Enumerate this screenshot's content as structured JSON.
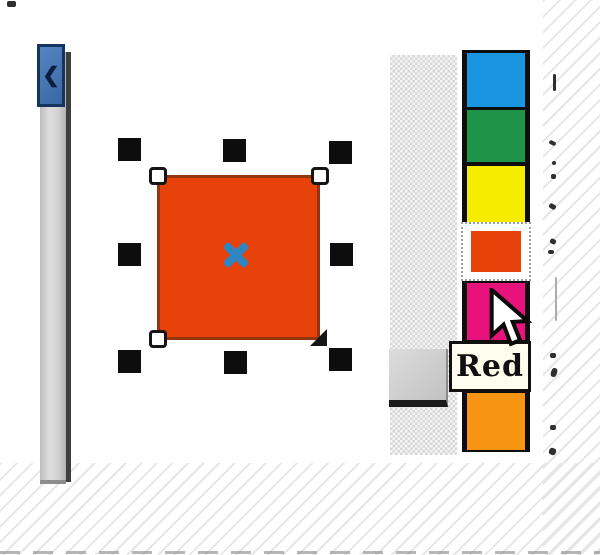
{
  "tooltip": {
    "text": "Red"
  },
  "palette": {
    "swatches": [
      {
        "name": "Blue",
        "color": "#1a96e0",
        "selected": false
      },
      {
        "name": "Green",
        "color": "#1f9347",
        "selected": false
      },
      {
        "name": "Yellow",
        "color": "#f6ec00",
        "selected": false
      },
      {
        "name": "Red",
        "color": "#e8420b",
        "selected": true
      },
      {
        "name": "Magenta",
        "color": "#e8127d",
        "selected": false
      },
      {
        "name": "Orange",
        "color": "#f79413",
        "selected": false
      }
    ]
  },
  "canvas": {
    "selected_object": {
      "type": "rectangle",
      "fill": "#e8420b",
      "outline": "#943511",
      "handle_color": "#0d0d0d",
      "center_marker_color": "#2e86c1"
    }
  },
  "chrome": {
    "scrollbar_color": "#cfcfcf",
    "toolbar_icon_color": "#3a67a4",
    "toolbar_icon_glyph": "❮"
  }
}
